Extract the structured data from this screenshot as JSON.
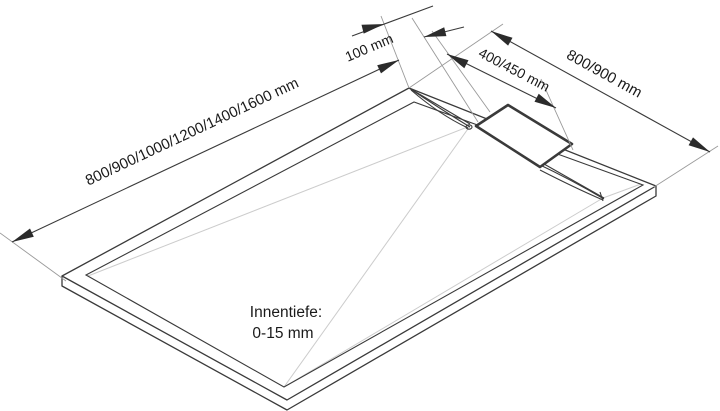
{
  "drawing": {
    "labels": {
      "length_dimension": "800/900/1000/1200/1400/1600 mm",
      "offset_dimension": "100 mm",
      "drain_dimension": "400/450 mm",
      "width_dimension": "800/900 mm",
      "inner_depth_caption": "Innentiefe:",
      "inner_depth_value": "0-15 mm"
    },
    "colors": {
      "background": "#ffffff",
      "outline": "#3a3a3a",
      "extension_line": "#9a9a9a",
      "fold_line": "#cccccc",
      "text": "#1a1a1a"
    }
  }
}
